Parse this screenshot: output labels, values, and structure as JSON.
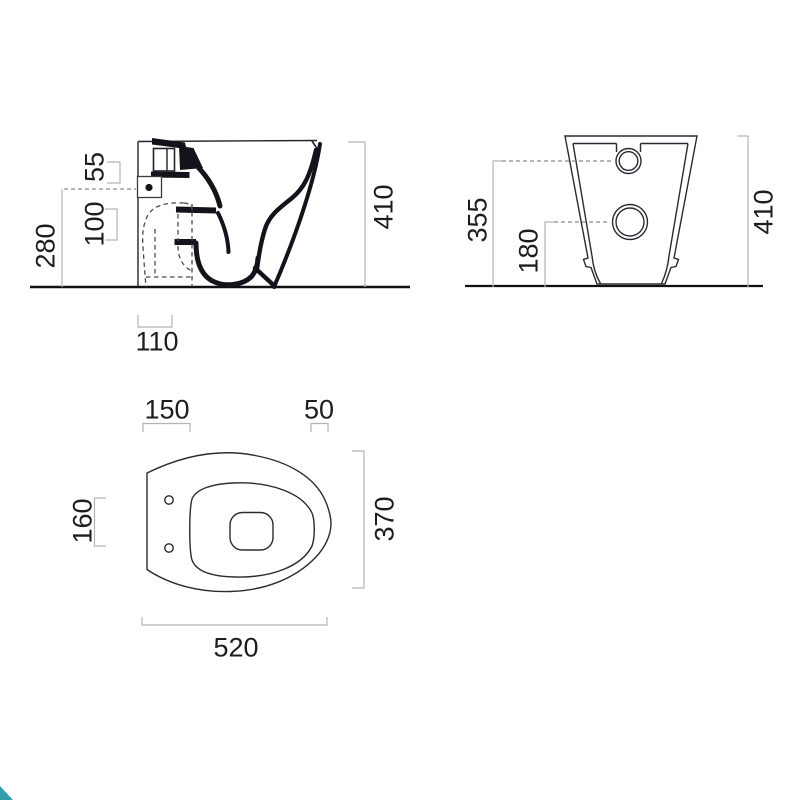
{
  "drawing": {
    "title": "WC pan technical dimension drawing",
    "accent_color": "#2f9fae",
    "side_view": {
      "name": "side elevation",
      "overall_height": "410",
      "inlet_bracket": "55",
      "inlet_center_height": "280",
      "inlet_drop": "100",
      "outlet_setback": "110"
    },
    "front_view": {
      "name": "rear elevation",
      "overall_height": "410",
      "inlet_height": "355",
      "outlet_height": "180"
    },
    "plan_view": {
      "name": "plan",
      "overall_depth": "520",
      "overall_width": "370",
      "fixing_zone": "150",
      "front_zone": "50",
      "fixing_spacing": "160"
    }
  }
}
